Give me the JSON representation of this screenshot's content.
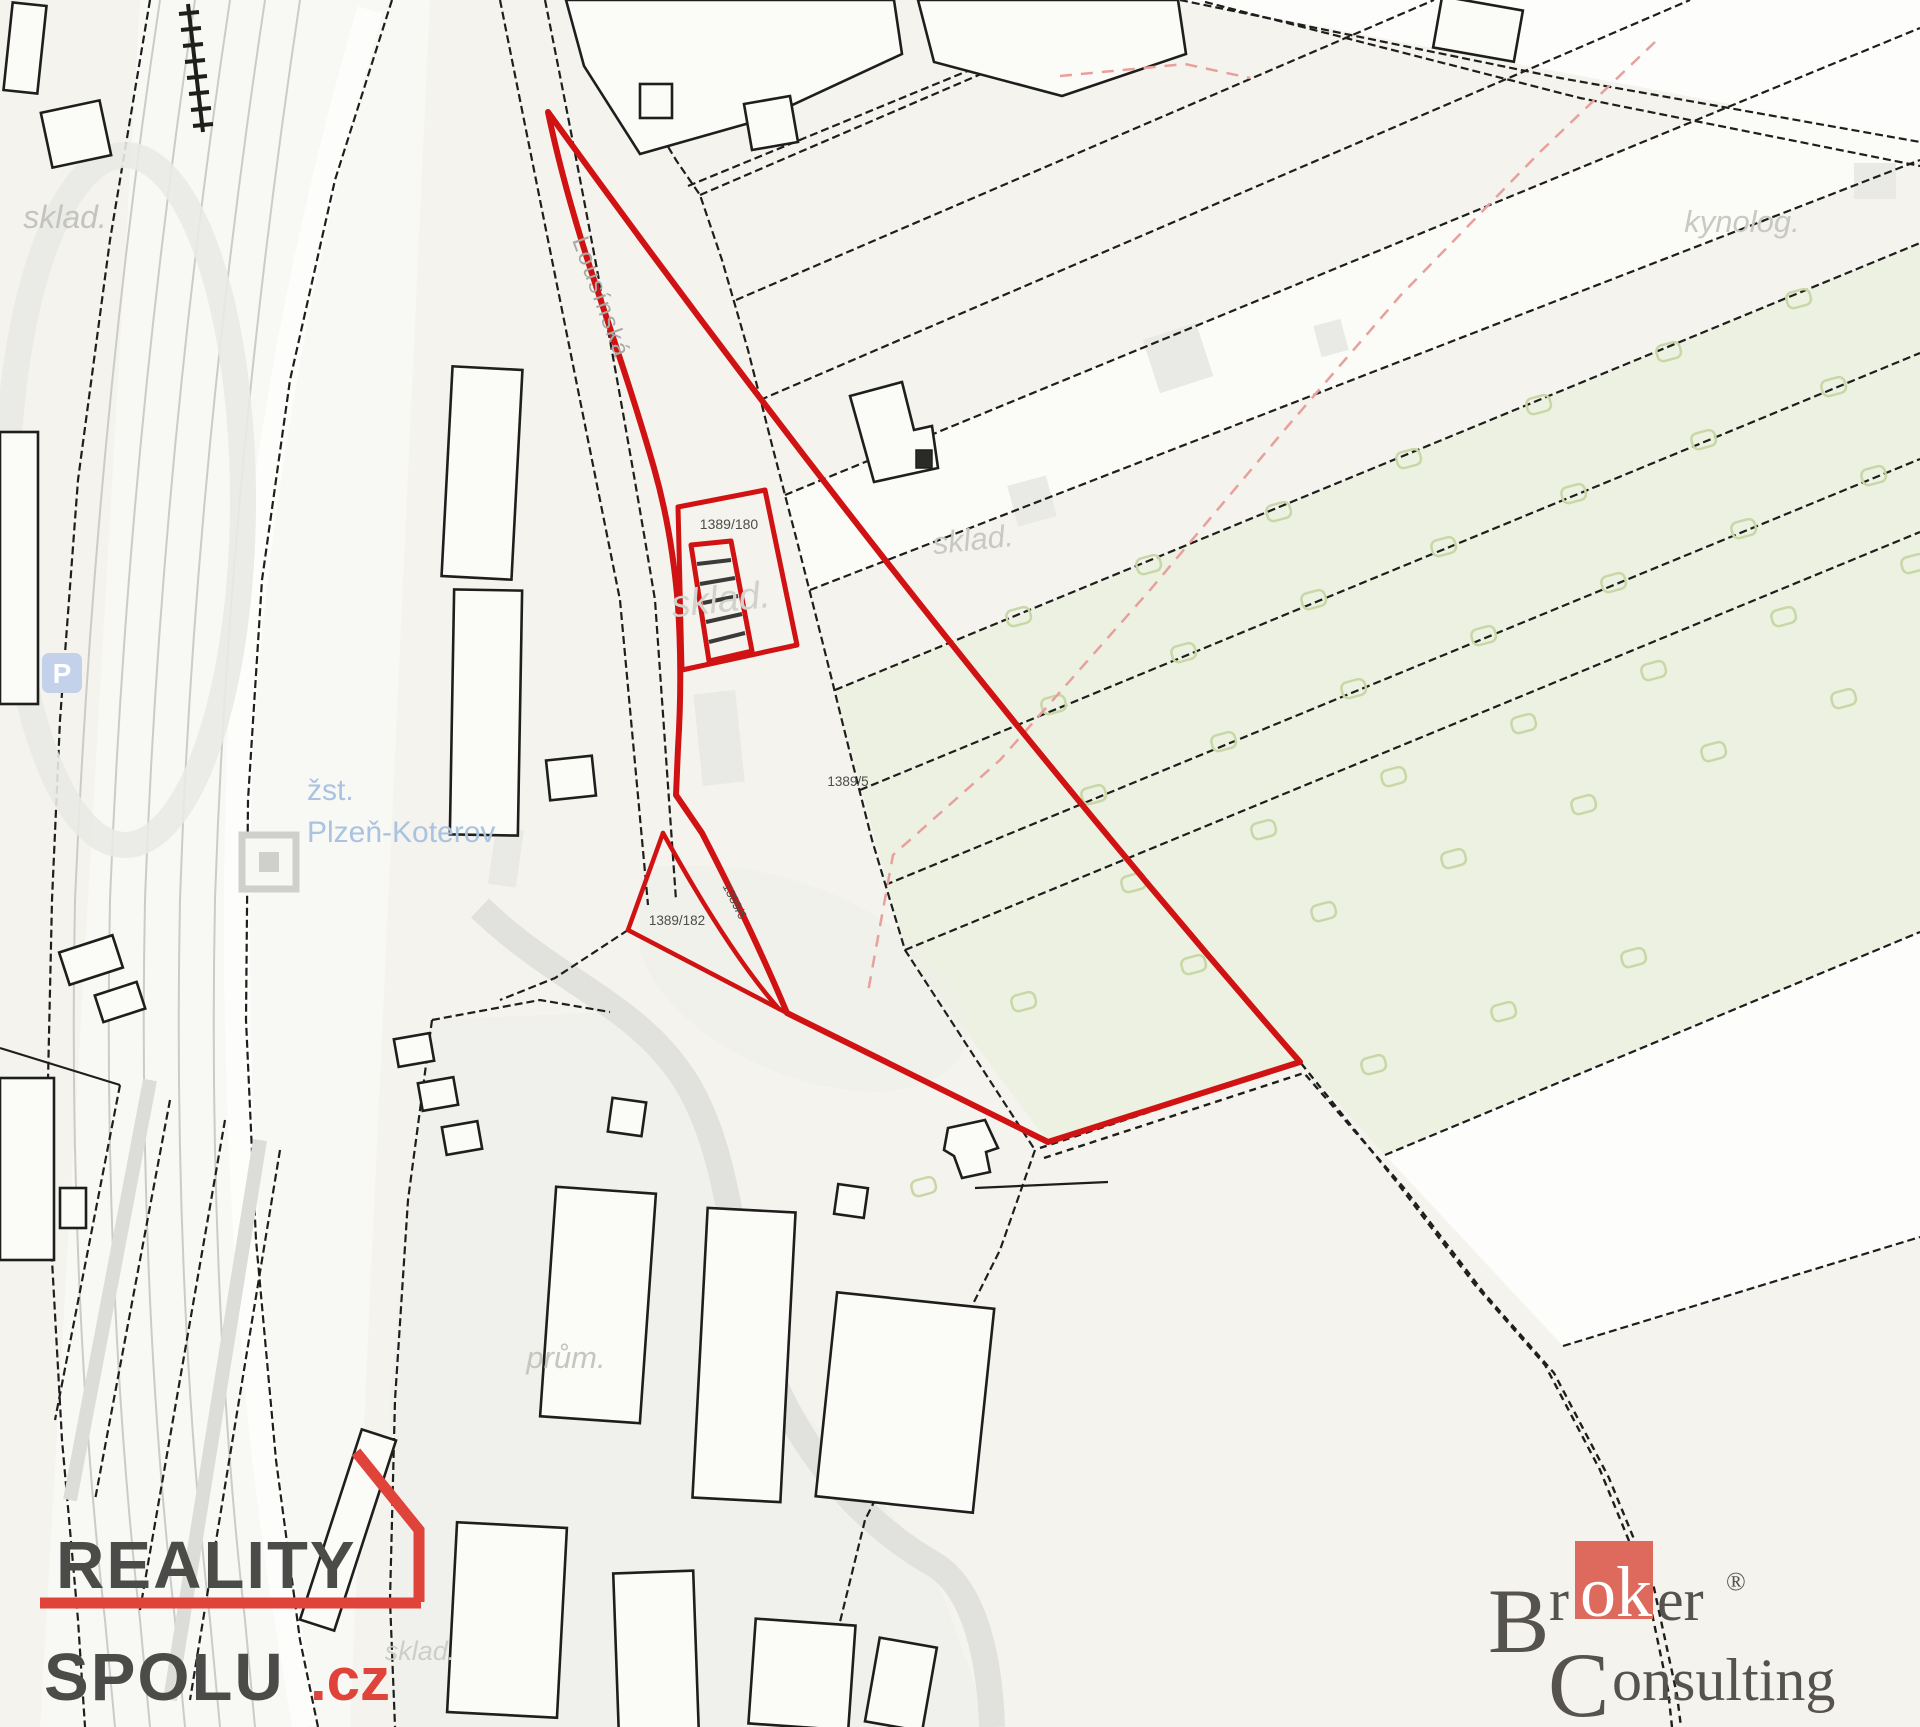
{
  "map": {
    "parcel_labels": {
      "p180": "1389/180",
      "p5": "1389/5",
      "p182": "1389/182",
      "p6": "1389/6"
    },
    "area_labels": {
      "sklad_top_left": "sklad.",
      "sklad_center": "sklad.",
      "sklad_under_building": "sklad.",
      "sklad_bottom": "sklad.",
      "kynolog": "kynolog.",
      "prum": "prům."
    },
    "street_label": "Lousínská",
    "station_label": {
      "line1": "žst.",
      "line2": "Plzeň-Koterov"
    },
    "parking_icon_letter": "P",
    "colors": {
      "background": "#f4f3ee",
      "line": "#1e1e1c",
      "highlight": "#d01212",
      "green_area": "#edf1e2",
      "bush": "#c8d7a6",
      "pink_dash": "#e8a09c",
      "station_blue": "#a9c3e1",
      "parking_blue": "#c3d2ea",
      "label_gray": "#c6c6c1",
      "parcel_number": "#4c4c48",
      "road_gray": "#cbcbc8"
    },
    "bushes": [
      [
        1005,
        612
      ],
      [
        1135,
        560
      ],
      [
        1265,
        507
      ],
      [
        1395,
        454
      ],
      [
        1525,
        400
      ],
      [
        1655,
        347
      ],
      [
        1785,
        294
      ],
      [
        1040,
        700
      ],
      [
        1170,
        648
      ],
      [
        1300,
        595
      ],
      [
        1430,
        542
      ],
      [
        1560,
        489
      ],
      [
        1690,
        435
      ],
      [
        1820,
        382
      ],
      [
        1080,
        790
      ],
      [
        1210,
        737
      ],
      [
        1340,
        684
      ],
      [
        1470,
        631
      ],
      [
        1600,
        578
      ],
      [
        1730,
        524
      ],
      [
        1860,
        471
      ],
      [
        1120,
        878
      ],
      [
        1250,
        825
      ],
      [
        1380,
        772
      ],
      [
        1510,
        719
      ],
      [
        1640,
        666
      ],
      [
        1770,
        612
      ],
      [
        1900,
        559
      ],
      [
        1180,
        960
      ],
      [
        1310,
        907
      ],
      [
        1440,
        854
      ],
      [
        1570,
        800
      ],
      [
        1700,
        747
      ],
      [
        1830,
        694
      ],
      [
        1010,
        997
      ],
      [
        1360,
        1060
      ],
      [
        1490,
        1007
      ],
      [
        1620,
        953
      ],
      [
        910,
        1182
      ]
    ]
  },
  "branding": {
    "reality_spolu": {
      "word1": "REALITY",
      "word2": "SPOLU",
      "tld": ".cz",
      "accent": "#e0433a",
      "text": "#4b4b49"
    },
    "broker_consulting": {
      "b": "B",
      "r": "r",
      "ok": "ok",
      "er": "er",
      "reg": "®",
      "c": "C",
      "onsulting": "onsulting",
      "accent": "#dd6a5c",
      "text": "#56534f"
    }
  }
}
